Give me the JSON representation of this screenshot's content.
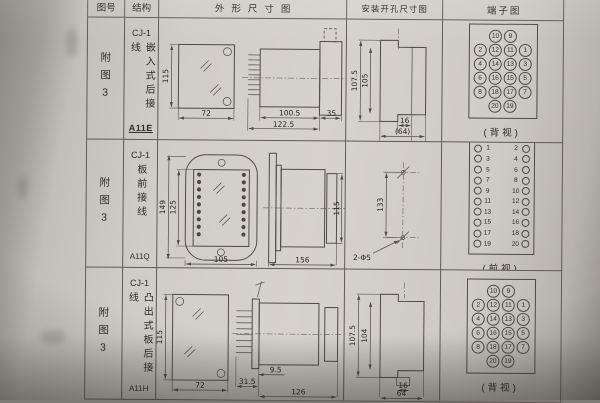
{
  "header": {
    "col_figure": "图号",
    "col_structure": "结构",
    "col_outline": "外形尺寸图",
    "col_install": "安装开孔尺寸图",
    "col_terminal": "端子图"
  },
  "rows": [
    {
      "figure_no": "附图3",
      "model": "CJ-1",
      "wiring": "嵌入式后接线",
      "code": "A11E",
      "outline": {
        "front_height": "115",
        "front_width": "72",
        "body_length": "100.5",
        "total_length": "122.5",
        "flange_depth": "35"
      },
      "install": {
        "outer_height": "107.5",
        "inner_height": "105",
        "notch_width": "16",
        "total_width": "(64)"
      },
      "terminal": {
        "view": "(背视)",
        "cells": [
          null,
          10,
          9,
          null,
          2,
          12,
          11,
          1,
          4,
          14,
          13,
          3,
          6,
          16,
          15,
          5,
          8,
          18,
          17,
          7,
          null,
          20,
          19,
          null
        ]
      }
    },
    {
      "figure_no": "附图3",
      "model": "CJ-1",
      "wiring": "板前接线",
      "code": "A11Q",
      "outline": {
        "flange_height": "149",
        "body_height": "125",
        "front_width": "105",
        "side_length": "156",
        "side_height": "115"
      },
      "install": {
        "hole_spacing": "133",
        "hole_spec": "2-Φ5"
      },
      "terminal": {
        "view": "(前视)",
        "left": [
          1,
          3,
          5,
          7,
          9,
          11,
          13,
          15,
          17,
          19
        ],
        "right": [
          2,
          4,
          6,
          8,
          10,
          12,
          14,
          16,
          18,
          20
        ]
      }
    },
    {
      "figure_no": "附图3",
      "model": "CJ-1",
      "wiring": "凸出式板后接线",
      "code": "A11H",
      "outline": {
        "front_height": "115",
        "front_width": "72",
        "terminal_depth": "31.5",
        "stud_depth": "9.5",
        "body_length": "126"
      },
      "install": {
        "outer_height": "107.5",
        "inner_height": "104",
        "stud_width": "16",
        "total_width": "64"
      },
      "terminal": {
        "view": "(背视)",
        "cells": [
          null,
          10,
          9,
          null,
          2,
          12,
          11,
          1,
          4,
          14,
          13,
          3,
          6,
          16,
          15,
          5,
          8,
          18,
          17,
          7,
          null,
          20,
          19,
          null
        ]
      }
    }
  ]
}
